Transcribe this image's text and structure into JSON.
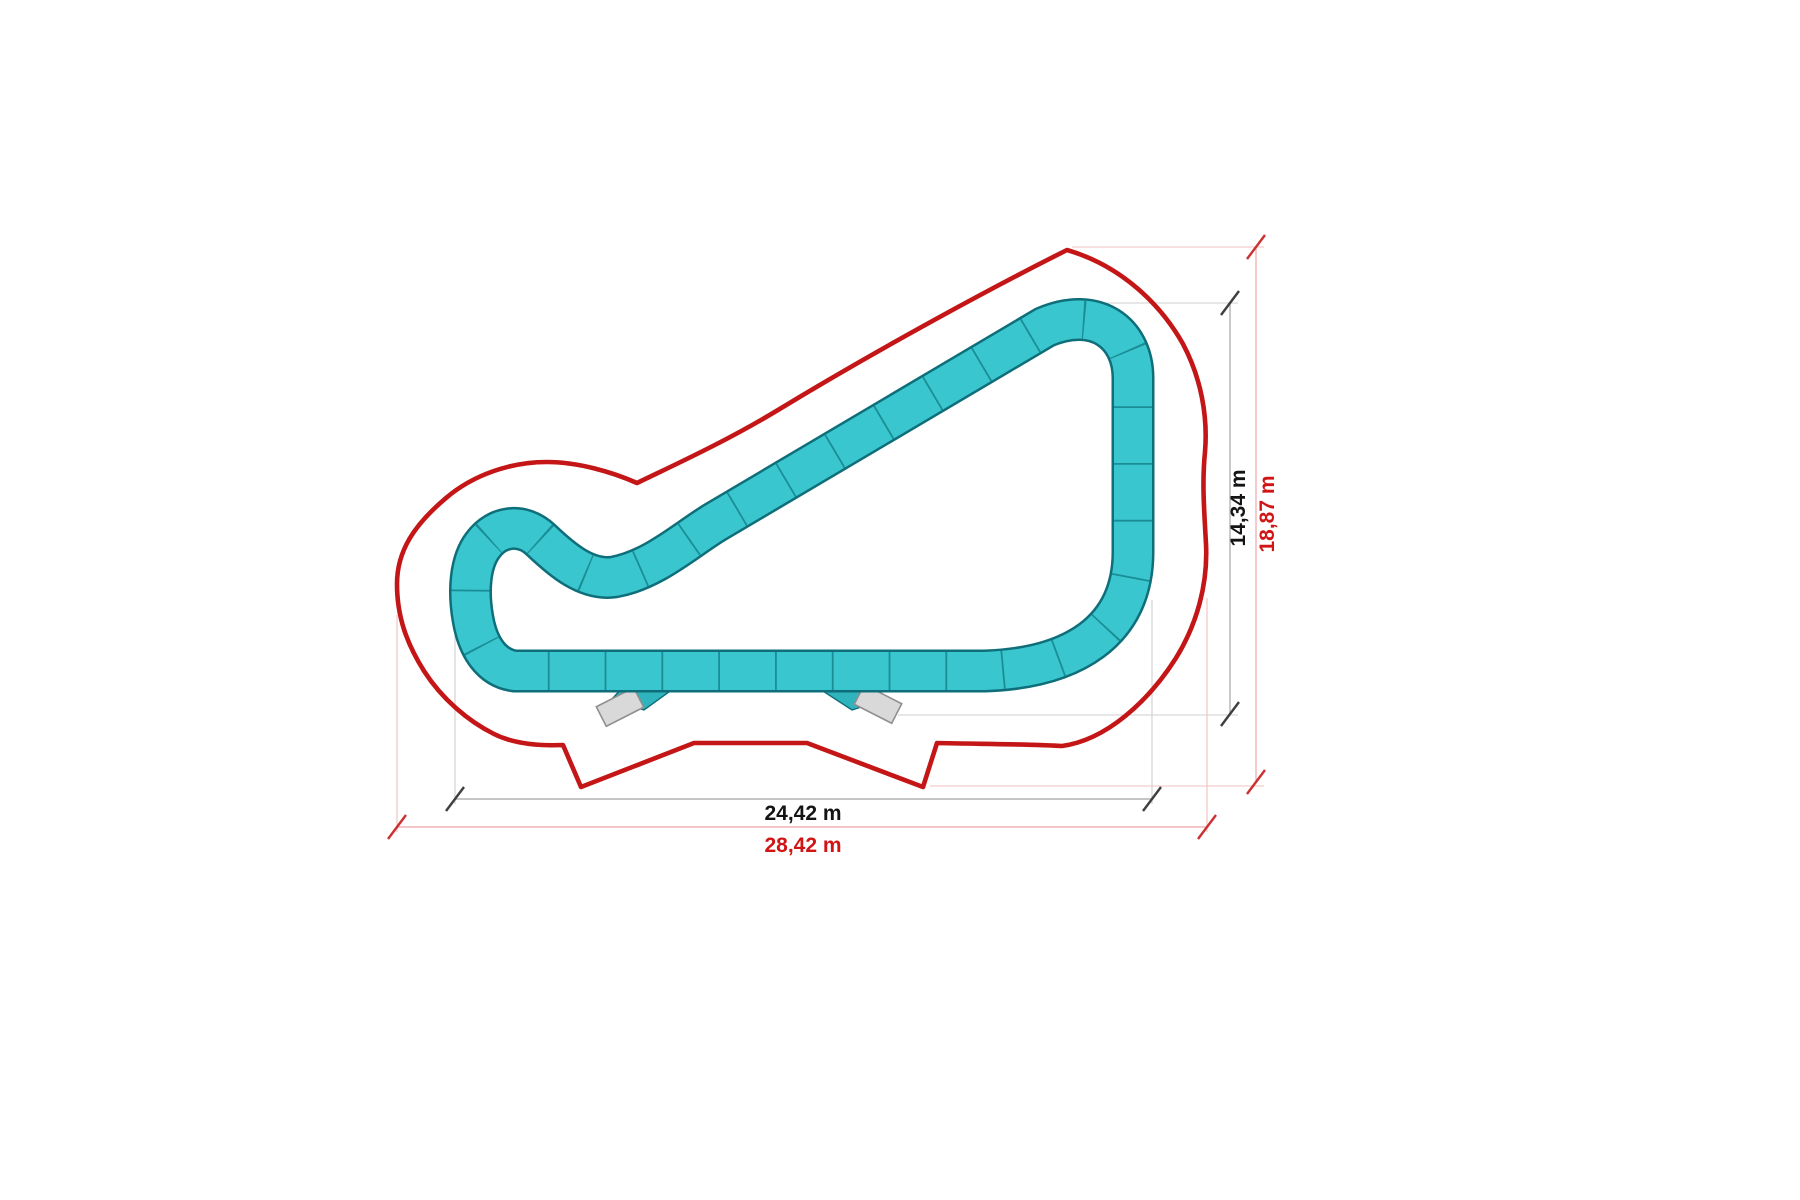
{
  "dimensions": {
    "inner_width": "24,42 m",
    "inner_height": "14,34 m",
    "outer_width": "28,42 m",
    "outer_height": "18,87 m"
  },
  "colors": {
    "track_fill": "#3ac6ce",
    "track_edge": "#0e6e79",
    "track_divider": "#137f8a",
    "boundary_red": "#c41616",
    "dim_gray_line": "#b3b3b3",
    "dim_pale_red_line": "#f0b4b4",
    "label_black": "#141414",
    "label_red": "#d11414"
  }
}
